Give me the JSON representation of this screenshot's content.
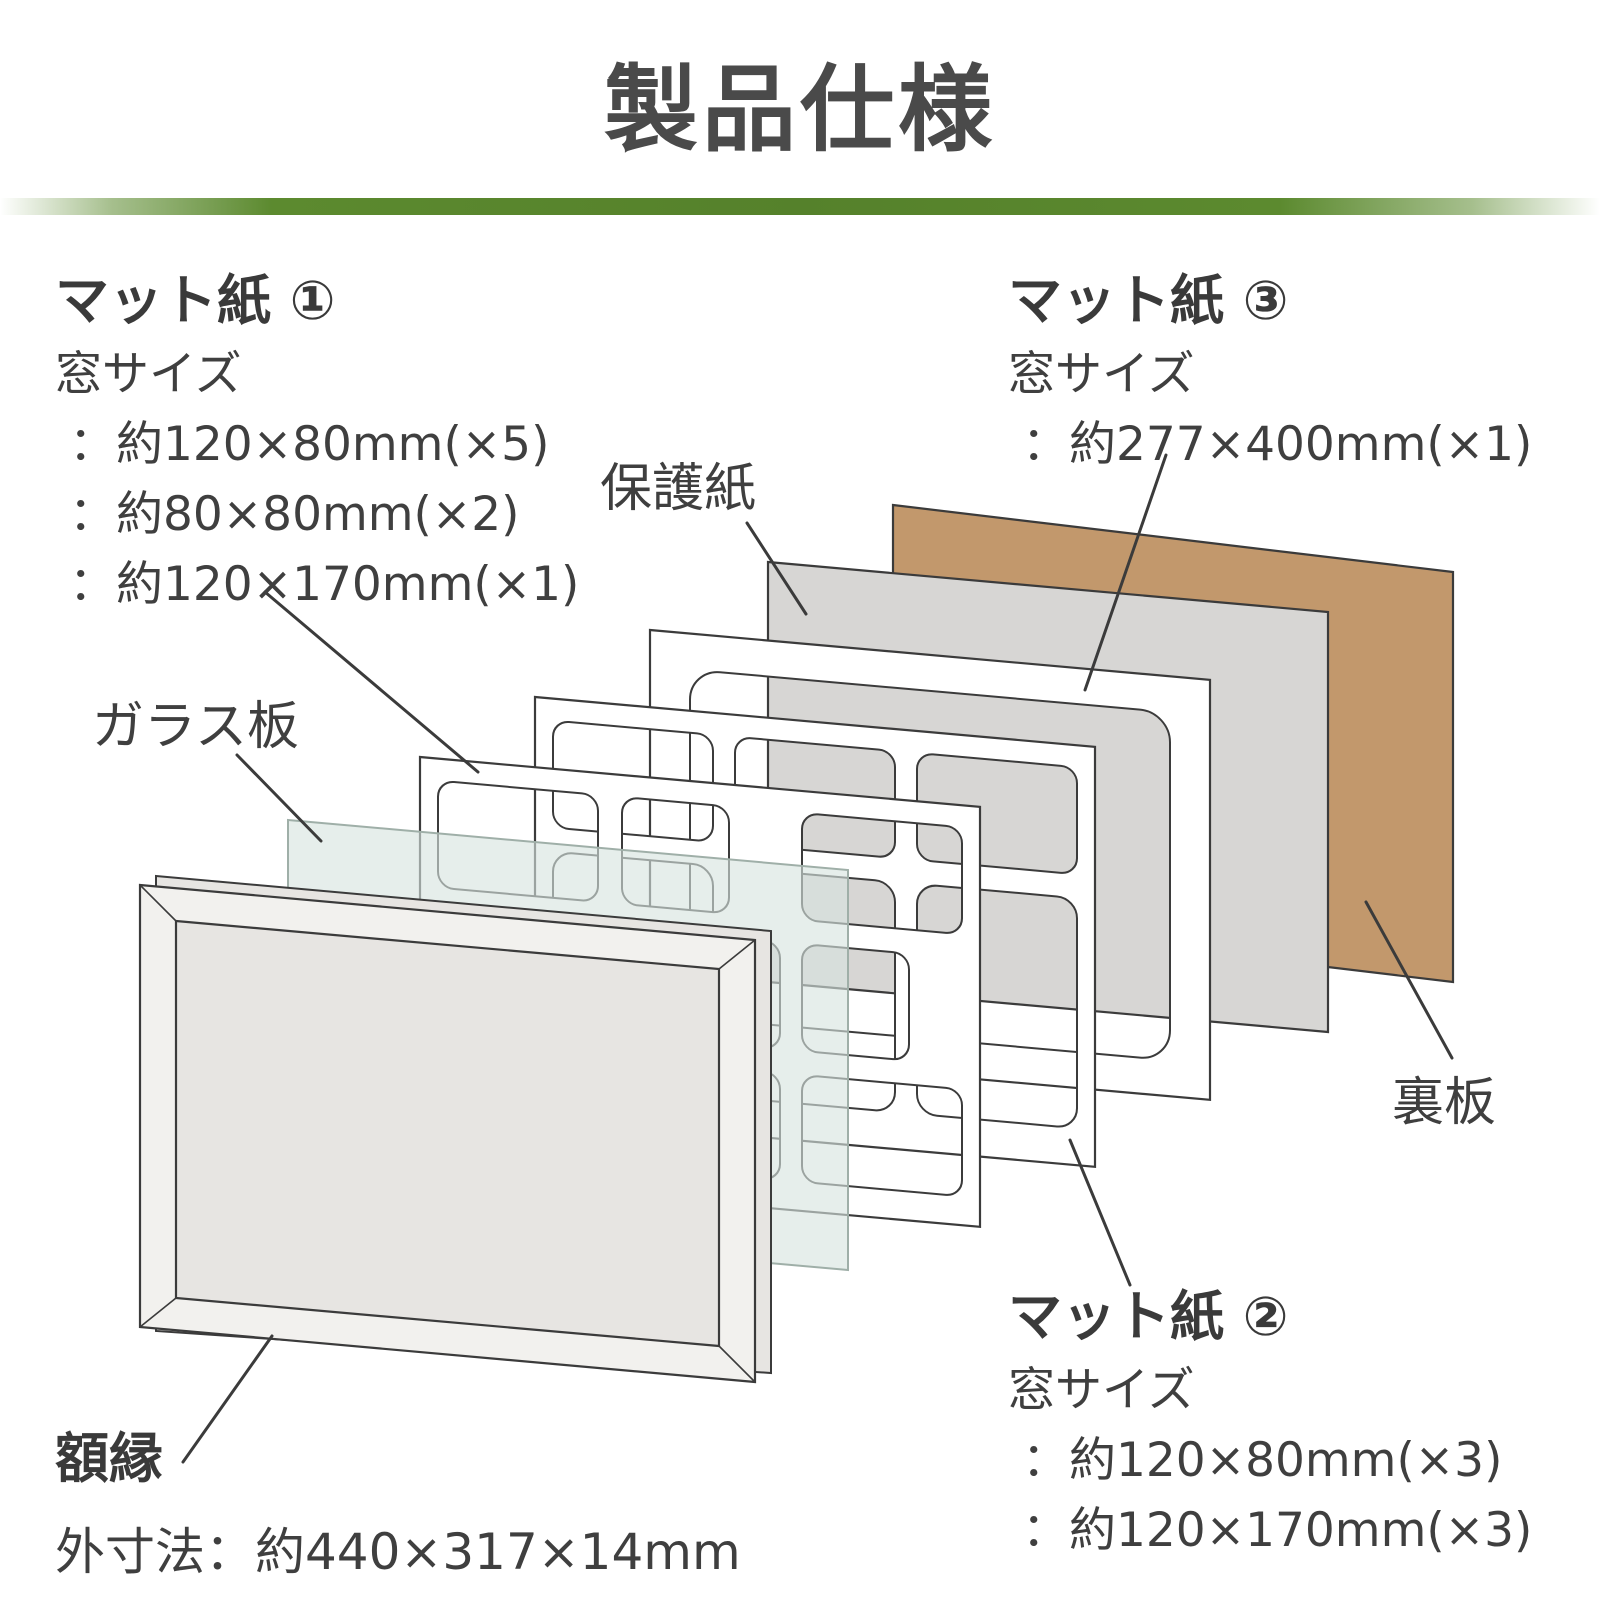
{
  "title": "製品仕様",
  "diagram": {
    "mat1": {
      "title": "マット紙 ①",
      "subtitle": "窓サイズ",
      "sizes": [
        "：約120×80mm(×5)",
        "：約80×80mm(×2)",
        "：約120×170mm(×1)"
      ]
    },
    "mat3": {
      "title": "マット紙 ③",
      "subtitle": "窓サイズ",
      "sizes": [
        "：約277×400mm(×1)"
      ]
    },
    "mat2": {
      "title": "マット紙 ②",
      "subtitle": "窓サイズ",
      "sizes": [
        "：約120×80mm(×3)",
        "：約120×170mm(×3)"
      ]
    },
    "protective_paper_label": "保護紙",
    "glass_label": "ガラス板",
    "back_board_label": "裏板",
    "frame_label": "額縁",
    "frame_spec": "外寸法：約440×317×14mm"
  },
  "colors": {
    "back_board": "#c2986c",
    "protective_paper": "#d7d6d4",
    "glass": "rgba(214,228,222,0.62)",
    "outline": "#3b3b3b",
    "accent_green": "#5c8a2f",
    "text": "#3f3f3f"
  }
}
